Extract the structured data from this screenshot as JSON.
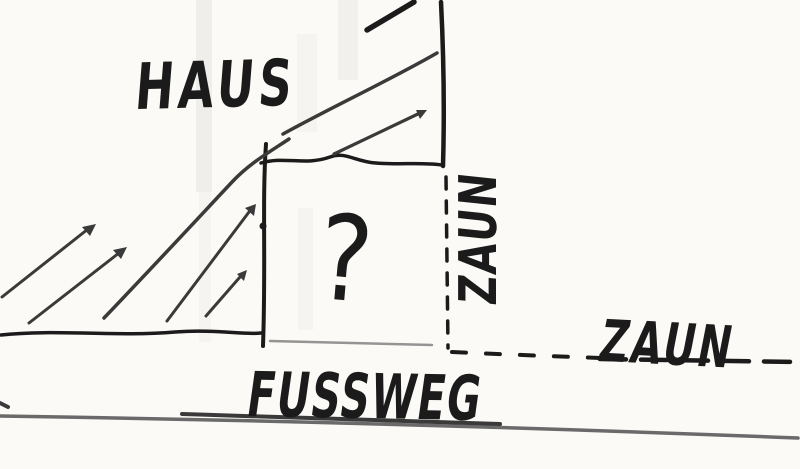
{
  "sketch": {
    "labels": {
      "haus": "HAUS",
      "zaun_vertical": "ZAUN",
      "zaun_horizontal": "ZAUN",
      "fussweg": "FUSSWEG",
      "question_mark": "?"
    },
    "colors": {
      "paper": "#fbfaf7",
      "ink": "#1b1b1b",
      "ink_soft": "#3a3a3a",
      "pencil": "#6a6a6a",
      "pencil_light": "#949494"
    }
  }
}
